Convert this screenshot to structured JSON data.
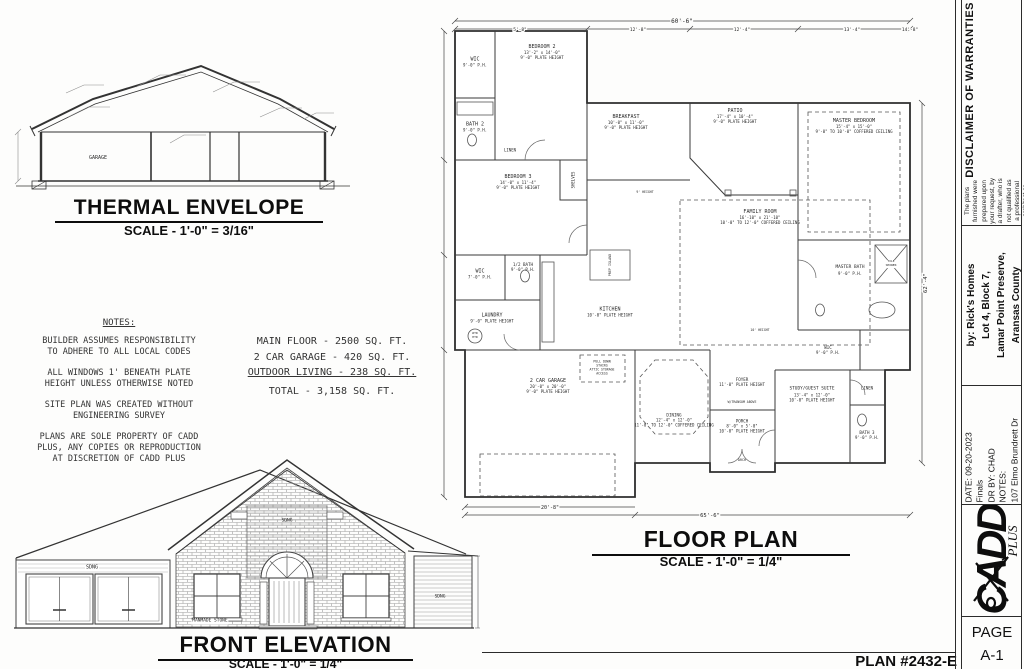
{
  "sheet": {
    "thermal": {
      "title": "THERMAL ENVELOPE",
      "scale": "SCALE - 1'-0\" = 3/16\"",
      "garage_label": "GARAGE"
    },
    "notes": {
      "heading": "NOTES:",
      "items": [
        "BUILDER ASSUMES RESPONSIBILITY\nTO ADHERE TO ALL LOCAL CODES",
        "ALL WINDOWS 1' BENEATH PLATE\nHEIGHT UNLESS OTHERWISE NOTED",
        "SITE PLAN WAS CREATED WITHOUT\nENGINEERING SURVEY",
        "PLANS ARE SOLE PROPERTY OF CADD\nPLUS, ANY COPIES OR REPRODUCTION\nAT DISCRETION OF CADD PLUS"
      ]
    },
    "areas": {
      "line1": "MAIN FLOOR - 2500 SQ. FT.",
      "line2": "2 CAR GARAGE - 420 SQ. FT.",
      "line3": "OUTDOOR LIVING - 238 SQ. FT.",
      "total": "TOTAL - 3,158 SQ. FT."
    },
    "floor_plan": {
      "title": "FLOOR PLAN",
      "scale": "SCALE - 1'-0\" = 1/4\"",
      "rooms": [
        {
          "name": "BEDROOM 2",
          "size": "13'-2\" x 14'-0\"",
          "height": "9'-0\" PLATE HEIGHT"
        },
        {
          "name": "WIC",
          "height": "9'-0\" P.H."
        },
        {
          "name": "BATH 2",
          "height": "9'-0\" P.H."
        },
        {
          "name": "LINEN"
        },
        {
          "name": "BEDROOM 3",
          "size": "14'-0\" x 11'-4\"",
          "height": "9'-0\" PLATE HEIGHT"
        },
        {
          "name": "SHELVES"
        },
        {
          "name": "BREAKFAST",
          "size": "10'-0\" x 11'-0\"",
          "height": "9'-0\" PLATE HEIGHT"
        },
        {
          "name": "PATIO",
          "size": "17'-4\" x 10'-4\"",
          "height": "9'-0\" PLATE HEIGHT"
        },
        {
          "name": "MASTER BEDROOM",
          "size": "15'-4\" x 15'-0\"",
          "height": "9'-0\" TO 10'-0\" COFFERED CEILING"
        },
        {
          "name": "FAMILY ROOM",
          "size": "16'-10\" x 21'-10\"",
          "height": "10'-0\" TO 12'-0\" COFFERED CEILING"
        },
        {
          "name": "KITCHEN",
          "height": "10'-0\" PLATE HEIGHT"
        },
        {
          "name": "PREP ISLAND"
        },
        {
          "name": "1/2 BATH",
          "height": "9'-0\" P.H."
        },
        {
          "name": "WIC",
          "height": "7'-0\" P.H."
        },
        {
          "name": "LAUNDRY",
          "height": "9'-0\" PLATE HEIGHT"
        },
        {
          "name": "2 CAR GARAGE",
          "size": "20'-0\" x 20'-0\"",
          "height": "9'-0\" PLATE HEIGHT"
        },
        {
          "name": "DINING",
          "size": "12'-4\" x 12'-0\"",
          "height": "11'-0\" TO 12'-0\" COFFERED CEILING"
        },
        {
          "name": "FOYER",
          "height": "11'-0\" PLATE HEIGHT"
        },
        {
          "name": "PORCH",
          "size": "8'-0\" x 5'-0\"",
          "height": "10'-0\" PLATE HEIGHT"
        },
        {
          "name": "STUDY/GUEST SUITE",
          "size": "13'-4\" x 12'-0\"",
          "height": "10'-0\" PLATE HEIGHT"
        },
        {
          "name": "WIC",
          "height": "9'-0\" P.H."
        },
        {
          "name": "MASTER BATH",
          "height": "9'-0\" P.H."
        },
        {
          "name": "BATH 3",
          "height": "9'-0\" P.H."
        },
        {
          "name": "LINEN"
        }
      ],
      "annotations": {
        "pull_down": "PULL DOWN\nSTAIRS\nATTIC STORAGE\nACCESS",
        "arch": "ARCH",
        "transom": "W/TRANSOM ABOVE",
        "wtr_htr": "WTR\nHTR",
        "tile_shower": "TILE\nSHOWER",
        "height9": "9' HEIGHT",
        "height10": "10' HEIGHT"
      },
      "dimensions": {
        "top": "60'-6\"",
        "top_segments": [
          "5'-8\"",
          "12'-8\"",
          "12'-4\"",
          "13'-4\"",
          "14'-8\""
        ],
        "bottom_left": "20'-8\"",
        "bottom": "65'-6\"",
        "right": "62'-4\""
      }
    },
    "elevation": {
      "title": "FRONT ELEVATION",
      "scale": "SCALE - 1'-0\" = 1/4\"",
      "siding_label": "SDNG",
      "stone_label": "MANMADE STONE"
    },
    "plan_number": "PLAN #2432-E",
    "title_block": {
      "disclaimer": {
        "title": "DISCLAIMER OF WARRANTIES",
        "body": "The plans furnished were prepared upon your request, by a drafter, who is not qualified as a professional architect or engineer, and these plans are for INFORMATION USE ONLY.  CADD Plus expressly disclaims any liability whatsoever for errors of any kind which may be found on any plan.  Use of such plans shall be at the sole risk of the user(s)."
      },
      "client": {
        "line1": "by: Rick's Homes",
        "line2": "Lot 4, Block 7,",
        "line3": "Lamar Point Preserve,",
        "line4": "Aransas County"
      },
      "info": {
        "date": "DATE: 09-20-2023",
        "phase": "Finals",
        "drawn_by": "DR BY: CHAD",
        "notes_label": "NOTES:",
        "address": "107 Elmo Brundrett Dr"
      },
      "logo": {
        "name": "CADD",
        "sub": "PLUS"
      },
      "page": {
        "label": "PAGE",
        "number": "A-1"
      }
    }
  }
}
